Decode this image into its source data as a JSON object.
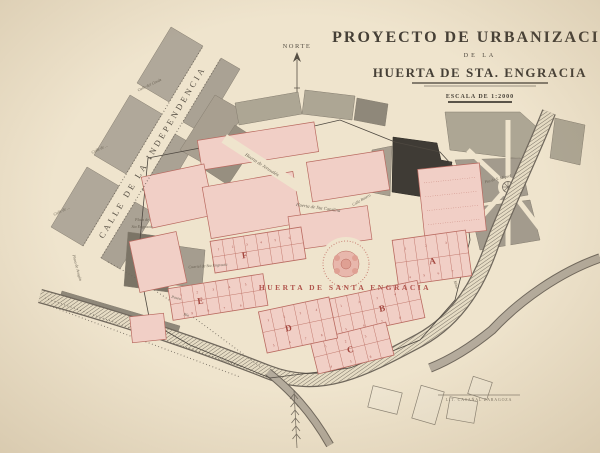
{
  "map": {
    "title": "PROYECTO DE URBANIZACIÓN",
    "subtitle": "DE LA",
    "title2": "HUERTA DE STA. ENGRACIA",
    "scale": "ESCALA DE 1:2000",
    "north": "NORTE",
    "credit": "LIT. CASAÑAL ZARAGOZA"
  },
  "streets": {
    "independencia": "CALLE DE LA INDEPENDENCIA",
    "side1": "Calle del Conde",
    "side2": "Calle de ...",
    "side3": "Calle de ...",
    "botero": "Calle Botero"
  },
  "places": {
    "huerta_main": "HUERTA DE SANTA ENGRACIA",
    "huerta_jerusalen": "Huerta de Jerusalén",
    "huerta_catalina": "Huerta de Sta Catalina",
    "plaza_engracia_l1": "Plaza de",
    "plaza_engracia_l2": "Sta Engracia",
    "cuartel": "Cuartel de Sta Engracia",
    "plaza_aragon": "Plaza de Aragón",
    "plaza_miguel": "Pza de S. Miguel",
    "paseo": "Paseo",
    "rio": "Río",
    "mina": "Mina"
  },
  "blocks": [
    {
      "letter": "A",
      "lots_top": "1 2 3",
      "lots_bottom": "4 5 6 7"
    },
    {
      "letter": "B",
      "lots_top": "1 2 3 4",
      "lots_bottom": "5 6 7 8"
    },
    {
      "letter": "C",
      "lots_top": "1 2 3",
      "lots_bottom": "4 5 6"
    },
    {
      "letter": "D",
      "lots_top": "1 2 3 4",
      "lots_bottom": "5 6 7 8"
    },
    {
      "letter": "E",
      "lots_top": "1 2 3 4 5",
      "lots_bottom": "9 8 7 6"
    },
    {
      "letter": "F",
      "lots_top": "1 2 3 4 5 6",
      "lots_bottom": ""
    }
  ],
  "colors": {
    "paper": "#efe4cd",
    "block_pink": "#f1cfc6",
    "plan_red": "#b0544c",
    "old_town_gray": "#b0a89a",
    "ink": "#575046"
  }
}
